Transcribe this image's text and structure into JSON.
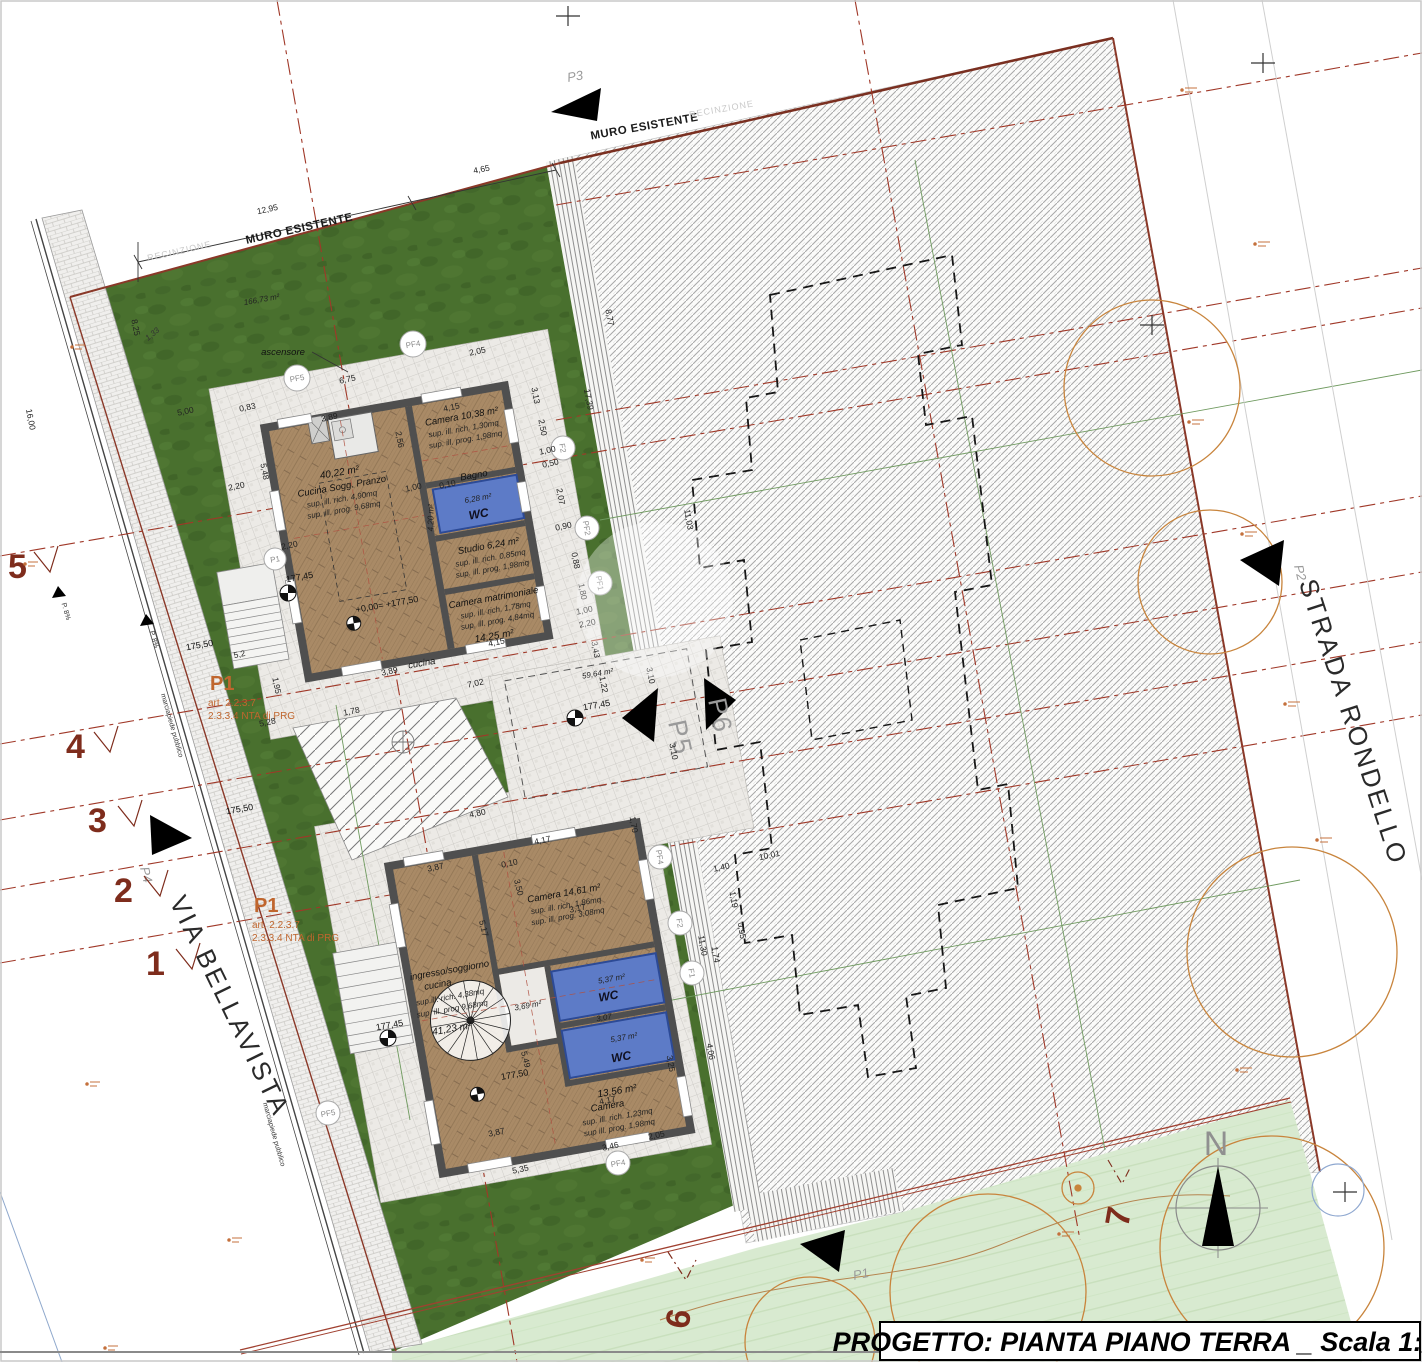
{
  "title_block": {
    "label": "PROGETTO: PIANTA PIANO TERRA _ Scala 1:100"
  },
  "streets": {
    "via_bellavista": "VIA BELLAVISTA",
    "strada_rondello": "STRADA RONDELLO",
    "marciapiede1": "marciapiede pubblico",
    "marciapiede2": "marciapiede pubblico",
    "ramp1": "P. 8%",
    "ramp2": "P. 8%"
  },
  "boundaries": {
    "muro_left": "MURO ESISTENTE",
    "muro_right": "MURO ESISTENTE",
    "recinzione_left": "RECINZIONE",
    "recinzione_right": "RECINZIONE"
  },
  "compass": {
    "north": "N"
  },
  "zone_a": {
    "p1": "P1",
    "art1": "art. 2.2.3.7",
    "art2": "2.3.3.4 NTA di PRG"
  },
  "zone_b": {
    "p1": "P1",
    "art1": "art. 2.2.3.7",
    "art2": "2.3.3.4 NTA di PRG"
  },
  "section_markers": {
    "s1": "1",
    "s2": "2",
    "s3": "3",
    "s4": "4",
    "s5": "5",
    "s6": "6",
    "s7": "7"
  },
  "direction_markers": {
    "p1": "P1",
    "p2": "P2",
    "p3": "P3",
    "p4": "P4",
    "p5": "P5",
    "p6": "P6"
  },
  "point_markers": {
    "pf1": "PF1",
    "pf2": "PF2",
    "pf4": "PF4",
    "pf5": "PF5",
    "f1": "F1",
    "f2": "F2",
    "p1c": "P1"
  },
  "garden": {
    "area": "166,73 m²",
    "ascensore": "ascensore",
    "court_area": "59,64 m²"
  },
  "levels": {
    "l1": "175,50",
    "l2": "175,50",
    "l3": "177,45",
    "l4": "177,45",
    "l5": "177,45",
    "l6": "+0,00= +177,50",
    "l7": "177,50"
  },
  "upper_house": {
    "living": {
      "area": "40,22 m²",
      "name": "Cucina Sogg. Pranzo",
      "rich": "sup. ill. rich. 4,90mq",
      "prog": "sup. ill. prog. 9,68mq"
    },
    "camera": {
      "name": "Camera  10,38 m²",
      "rich": "sup. ill. rich. 1,30mq",
      "prog": "sup. ill. prog. 1,98mq"
    },
    "bagno": {
      "name": "Bagno",
      "area": "6,28 m²",
      "wc": "WC"
    },
    "studio": {
      "name": "Studio 6,24 m²",
      "rich": "sup. ill. rich. 0,85mq",
      "prog": "sup. ill. prog. 1,98mq"
    },
    "matrimoniale": {
      "name": "Camera matrimoniale",
      "rich": "sup. ill. rich. 1,78mq",
      "prog": "sup. ill. prog. 4,84mq",
      "area": "14,25 m²"
    },
    "disimpegno": "4,20 m²",
    "cucina": "cucina"
  },
  "lower_house": {
    "camera1": {
      "name": "Camera  14,61 m²",
      "rich": "sup. ill. rich. 1,86mq",
      "prog": "sup. ill. prog. 3,08mq"
    },
    "living": {
      "name1": "ingresso/soggiorno",
      "name2": "cucina",
      "rich": "sup.ill. rich. 4,38mq",
      "prog": "sup. ill. prog 9,68mq",
      "area": "41,23 m²"
    },
    "wc1": {
      "wc": "WC",
      "area": "5,37 m²"
    },
    "wc2": {
      "wc": "WC",
      "area": "5,37 m²",
      "dim": "3,07"
    },
    "hall": "3,69 m²",
    "camera2": {
      "area": "13,56 m²",
      "name": "Camera",
      "rich": "sup. ill. rich. 1,23mq",
      "prog": "sup ill. prog. 1,98mq"
    }
  },
  "dims": {
    "d01": "12,95",
    "d02": "4,65",
    "d03": "8,77",
    "d04": "17,39",
    "d05": "3,13",
    "d06": "6,75",
    "d07": "2,05",
    "d08": "4,15",
    "d09": "2,50",
    "d10": "3,89",
    "d11": "0,83",
    "d12": "2,20",
    "d13": "5,48",
    "d14": "1,00",
    "d15": "0,50",
    "d16": "2,07",
    "d17": "0,90",
    "d18": "0,88",
    "d19": "1,80",
    "d20": "3,43",
    "d21": "4,15",
    "d22": "7,02",
    "d23": "3,10",
    "d24": "3,10",
    "d25": "4,80",
    "d26": "1,78",
    "d27": "5,2",
    "d28": "5,28",
    "d29": "1,95",
    "d30": "16,00",
    "d31": "5,00",
    "d32": "8,25",
    "d33": "1,33",
    "d34": "11,03",
    "d35": "10,01",
    "d36": "11,30",
    "d37": "4,06",
    "d38": "3,25",
    "d39": "2,05",
    "d40": "5,35",
    "d41": "3,46",
    "d42": "3,87",
    "d43": "4,17",
    "d44": "3,17",
    "d45": "5,17",
    "d46": "3,50",
    "d47": "5,49",
    "d48": "1,70",
    "d49": "2,56",
    "d50": "1,22",
    "d51": "1,00",
    "d52": "2,20",
    "d53": "4,17",
    "d54": "3,87",
    "d55": "2,20",
    "d56": "1,40",
    "d57": "1,19",
    "d58": "0,95",
    "d59": "1,74",
    "d60": "0,10",
    "d61": "0,10",
    "d62": "1,00",
    "d63": "3,89"
  },
  "colors": {
    "wall": "#4f4f4f",
    "wc_blue": "#5d7bc7",
    "grass": "#49702e",
    "grass_light": "#d8ead0",
    "boundary_red": "#8a3828",
    "dashdot_red": "#a03828",
    "accent_orange": "#c0662e"
  }
}
